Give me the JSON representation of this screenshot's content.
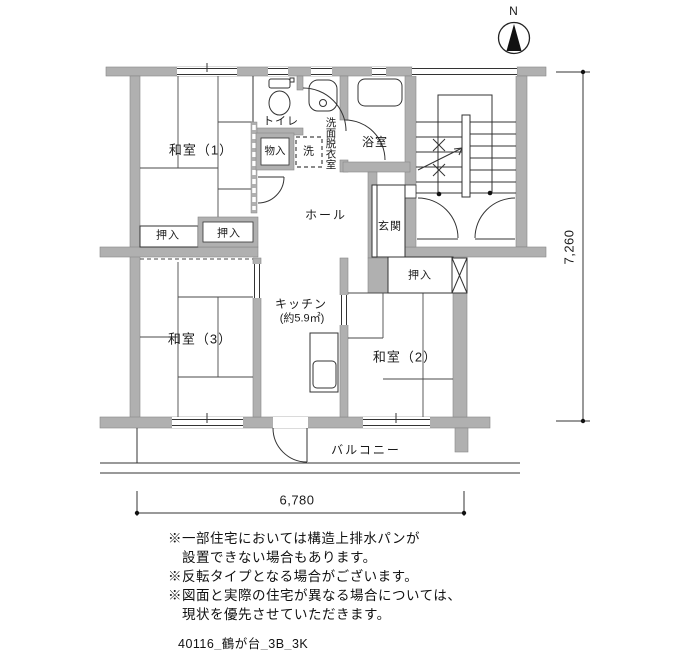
{
  "compass": {
    "label": "N"
  },
  "rooms": {
    "washitsu1": "和室（1）",
    "washitsu2": "和室（2）",
    "washitsu3": "和室（3）",
    "toilet": "トイレ",
    "washroom": "洗面脱衣室",
    "bath": "浴室",
    "storage": "物入",
    "laundry": "洗",
    "hall": "ホール",
    "entrance": "玄関",
    "closet": "押入",
    "kitchen": "キッチン",
    "kitchen_area": "(約5.9㎡)",
    "balcony": "バルコニー"
  },
  "dimensions": {
    "width": "6,780",
    "height": "7,260"
  },
  "notes": {
    "lines": [
      "※一部住宅においては構造上排水パンが",
      "　設置できない場合もあります。",
      "※反転タイプとなる場合がございます。",
      "※図面と実際の住宅が異なる場合については、",
      "　現状を優先させていただきます。"
    ]
  },
  "footer": {
    "text": "40116_鶴が台_3B_3K"
  },
  "colors": {
    "wall": "#b0b0b0",
    "line": "#333333",
    "background": "#ffffff"
  }
}
